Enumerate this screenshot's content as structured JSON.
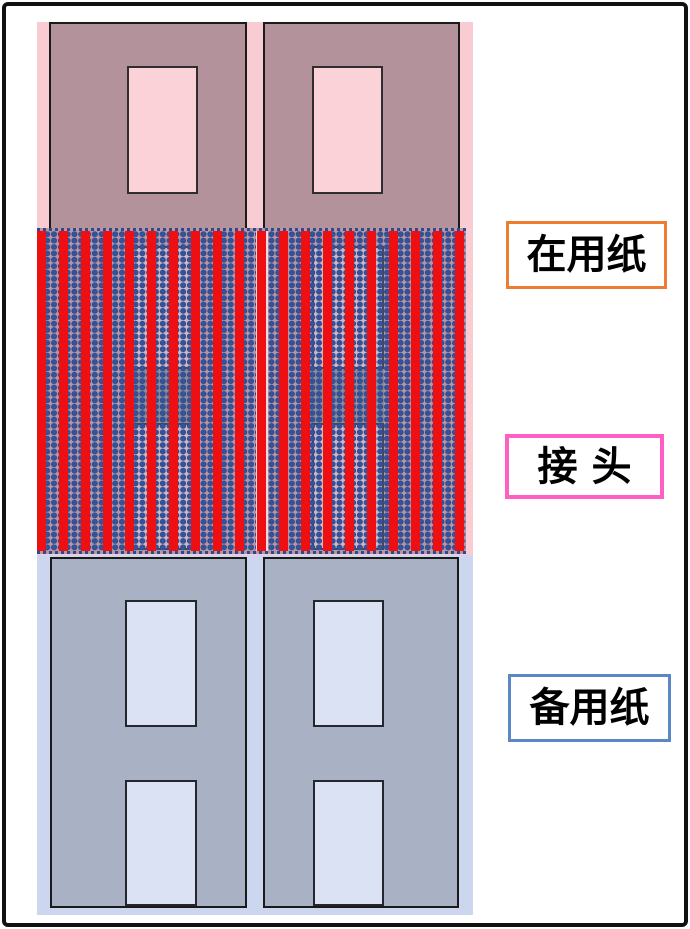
{
  "figure": {
    "type": "paper-splice-diagram",
    "labels": {
      "in_use": "在用纸",
      "joint": "接 头",
      "spare": "备用纸"
    }
  },
  "colors": {
    "frame-border": "#111111",
    "in-use-paper": "#B4929C",
    "in-use-window": "#FBD2D7",
    "in-use-backing": "#F8CCD2",
    "spare-paper": "#A9B1C4",
    "spare-window": "#DBE2F3",
    "spare-backing": "#CCD6EE",
    "splice-base": "#B795A5",
    "splice-ghost-window": "#D2B6C6",
    "splice-overlap-patch": "#8F8A99",
    "splice-gap-band": "#F5D8DE",
    "dot-navy": "#2C4B8C",
    "stripe-red": "#EE0F12",
    "label-in-use-border": "#ED7D31",
    "label-joint-border": "#FF5EC4",
    "label-spare-border": "#5B87C5"
  }
}
